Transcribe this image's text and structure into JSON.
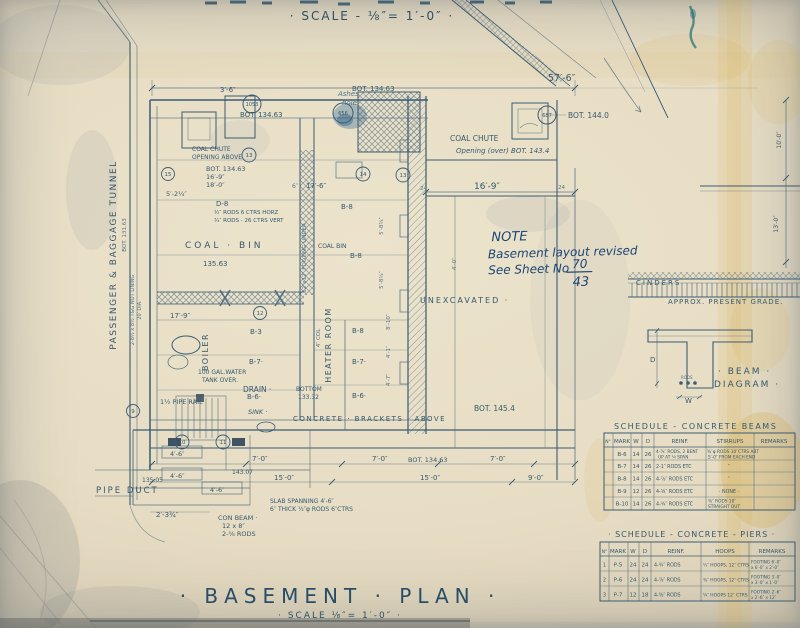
{
  "colors": {
    "paper": "#e8dfc8",
    "ink": "#3a5c74",
    "ink_dark": "#274d68",
    "hand_ink": "#1d4575",
    "stain_yellow": "#d7a93e",
    "stain_blue": "#3a6e95"
  },
  "header": {
    "scale_label": "· SCALE - ⅛″= 1′-0″ ·"
  },
  "title_block": {
    "title": "· BASEMENT · PLAN ·",
    "scale": "· SCALE ⅛″= 1′-0″ ·"
  },
  "note": {
    "line1": "NOTE",
    "line2": "Basement layout revised",
    "line3": "See Sheet No",
    "sheet_top": "70",
    "sheet_bottom": "43"
  },
  "tunnel": {
    "name": "PASSENGER & BAGGAGE TUNNEL",
    "lining1": "2-8½ x 8½ T&G NOT LINING",
    "lining2": "20′ DIA.",
    "bot": "BOT. 131.63"
  },
  "labels": {
    "unexcavated": "UNEXCAVATED ·",
    "coal_bin": "COAL · BIN",
    "coal_bin_small": "COAL  BIN",
    "boiler": "BOILER",
    "heater_room": "HEATER ROOM",
    "col4": "4″ COL",
    "pipe_duct": "PIPE  DUCT",
    "pipe_rail": "1½ PIPE RAIL",
    "drain": "DRAIN ·",
    "sink": "SINK ·",
    "brackets": "CONCRETE · BRACKETS · ABOVE",
    "bottom_word": "BOTTOM",
    "water1": "100 GAL.WATER",
    "water2": "TANK OVER.",
    "ashes1": "Ashes",
    "ashes2": "hole",
    "chute1a": "COAL CHUTE",
    "chute1b": "OPENING ABOVE",
    "chute2a": "COAL CHUTE",
    "chute2b": "Opening (over) BOT. 143.4",
    "rods_note1": "½″ RODS 6 CTRS HORZ",
    "rods_note2": "¾″ RODS - 26 CTRS VERT",
    "footing_under": "12″x12″ FOOTING UNDER",
    "slab1": "SLAB SPANNING 4′-6″",
    "slab2": "6″ THICK ½″φ RODS 6″CTRS",
    "conbeam1": "CON BEAM ·",
    "conbeam2": "12 x 8″",
    "conbeam3": "2-⅝ RODS",
    "b3": "B-3",
    "b6": "B-6·",
    "b7": "B-7·",
    "b8": "B-8",
    "d8": "D-8"
  },
  "elev": {
    "e134_63": "BOT. 134.63",
    "e144_0": "BOT. 144.0",
    "e145_4": "BOT. 145.4",
    "e135_63": "135.63",
    "e133_32": "133.32",
    "e135_05": "135.05",
    "e143_07": "143.07"
  },
  "dims": {
    "d57_6": "57′-6″",
    "d16_9": "16′-9″",
    "d18_0": "18′-0″",
    "d17_6": "17′-6″",
    "d17_9": "17′-9″",
    "d3_6": "3′-6″",
    "d5_2": "5′-2¼″",
    "d7_0": "7′-0″",
    "d15_0": "15′-0″",
    "d9_0": "9′-0″",
    "d4_6": "4′-6″",
    "d2_3": "2′-3¾″",
    "d24": "24",
    "d6": "6″",
    "d5_8": "5′-8¾″",
    "d4_1": "4′-1″",
    "d4_7": "4′-7″",
    "d8_10": "8′-10″",
    "d4_0": "4′-0″",
    "d10_0": "10′-0″",
    "d13_0": "13′-0″"
  },
  "bubbles": {
    "n9": "9",
    "n10": "10",
    "n11": "11",
    "n12": "12",
    "n13": "13",
    "n14": "14",
    "n15": "15",
    "n656": "656",
    "n687": "687",
    "n1053": "1053"
  },
  "grade": {
    "cinders": "CINDERS",
    "present_grade": "APPROX. PRESENT GRADE."
  },
  "beam_diagram": {
    "title1": "· BEAM ·",
    "title2": "DIAGRAM ·",
    "d": "D",
    "w": "W",
    "rods": "RODS"
  },
  "schedules": {
    "beams": {
      "title": "SCHEDULE - CONCRETE BEAMS",
      "headers": [
        "N°",
        "MARK",
        "W",
        "D",
        "REINF.",
        "STIRRUPS",
        "REMARKS"
      ],
      "rows": [
        {
          "no": "",
          "mark": "B-6",
          "w": "14",
          "d": "26",
          "r1": "4-⅞″ RODS, 2 BENT",
          "r2": "UP AT ¼ SPAN",
          "s1": "⅜″φ RODS 10″CTRS ABT",
          "s2": "5′-0″ FROM EACH END",
          "rem1": ""
        },
        {
          "no": "",
          "mark": "B-7",
          "w": "14",
          "d": "26",
          "r1": "2-1″ RODS  ETC",
          "r2": "",
          "s1": "″",
          "s2": "",
          "rem1": ""
        },
        {
          "no": "",
          "mark": "B-8",
          "w": "14",
          "d": "26",
          "r1": "4-⅞″ RODS  ETC",
          "r2": "",
          "s1": "″",
          "s2": "",
          "rem1": ""
        },
        {
          "no": "",
          "mark": "B-9",
          "w": "12",
          "d": "26",
          "r1": "4-⅝″ RODS  ETC",
          "r2": "",
          "s1": "· NONE ·",
          "s2": "",
          "rem1": ""
        },
        {
          "no": "",
          "mark": "B-10",
          "w": "14",
          "d": "26",
          "r1": "4-¾″ RODS  ETC",
          "r2": "",
          "s1": "⅜″ RODS 10″",
          "s2": "STRAIGHT OUT",
          "rem1": ""
        }
      ]
    },
    "piers": {
      "title": "· SCHEDULE - CONCRETE - PIERS ·",
      "headers": [
        "N°",
        "MARK",
        "W",
        "D",
        "REINF.",
        "HOOPS",
        "REMARKS"
      ],
      "rows": [
        {
          "no": "1",
          "mark": "P-5",
          "w": "24",
          "d": "24",
          "reinf": "4-¾″ RODS",
          "hoops": "½″ HOOPS, 12″ CTRS",
          "rem1": "FOOTING 6′-0″",
          "rem2": "x 6′-0″ x 2′-0″"
        },
        {
          "no": "2",
          "mark": "P-6",
          "w": "24",
          "d": "24",
          "reinf": "4-⅞″ RODS",
          "hoops": "⅜″ HOOPS, 12″ CTRS",
          "rem1": "FOOTING 3′-0″",
          "rem2": "x 3′-0″ x 1′-0″"
        },
        {
          "no": "3",
          "mark": "P-7",
          "w": "12",
          "d": "18",
          "reinf": "4-⅝″ RODS",
          "hoops": "¼″ HOOPS 12″ CTRS",
          "rem1": "FOOTING 2′-6″",
          "rem2": "x 2′-6″ x 12″"
        }
      ]
    }
  }
}
